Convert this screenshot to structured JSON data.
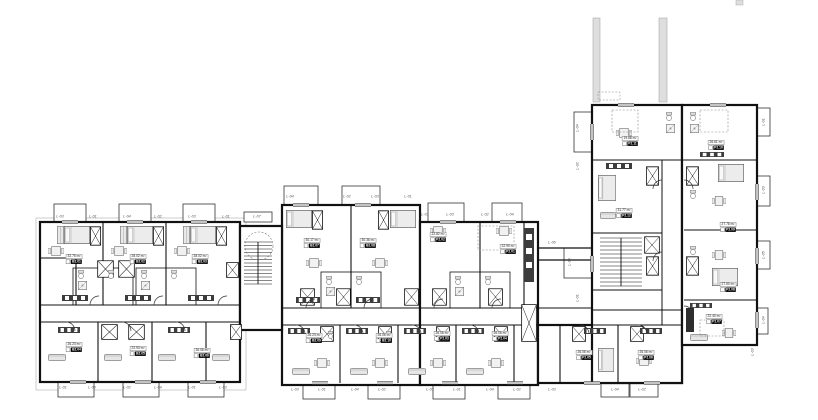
{
  "page": {
    "background": "#ffffff",
    "ink": "#111111",
    "shaft_grey": "#dedede"
  },
  "balconies": [
    "L-03",
    "L-01",
    "L-04",
    "L-02",
    "L-03",
    "L-01",
    "L-07",
    "L-01",
    "L-03",
    "L-02",
    "L-04",
    "L-01",
    "L-03",
    "L-04",
    "L-02",
    "L-03",
    "L-01",
    "L-01",
    "L-03",
    "L-02",
    "L-04",
    "L-03",
    "L-01",
    "L-04",
    "L-02",
    "L-03",
    "L-01",
    "L-04",
    "L-02",
    "L-03",
    "L-04",
    "L-02",
    "L-06",
    "L-04",
    "L-02",
    "L-03",
    "L-01",
    "L-01",
    "L-03",
    "L-05",
    "L-04",
    "L-03"
  ],
  "units": [
    {
      "code": "B2.01",
      "area": "32.75 m²"
    },
    {
      "code": "B2.02",
      "area": "28.02 m²"
    },
    {
      "code": "B2.03",
      "area": "28.02 m²"
    },
    {
      "code": "B2.04",
      "area": "26.23 m²"
    },
    {
      "code": "B2.05",
      "area": "22.93 m²"
    },
    {
      "code": "B2.06",
      "area": "26.06 m²"
    },
    {
      "code": "B2.07",
      "area": "30.17 m²"
    },
    {
      "code": "B2.08",
      "area": "30.36 m²"
    },
    {
      "code": "P2.02",
      "area": "22.82 m²"
    },
    {
      "code": "P2.01",
      "area": "22.90 m²"
    },
    {
      "code": "B2.09",
      "area": "26.23 m²"
    },
    {
      "code": "B2.10",
      "area": "26.06 m²"
    },
    {
      "code": "P2.03",
      "area": "26.06 m²"
    },
    {
      "code": "P2.04",
      "area": "26.06 m²"
    },
    {
      "code": "P2.05",
      "area": "26.06 m²"
    },
    {
      "code": "P2.06",
      "area": "26.06 m²"
    },
    {
      "code": "P2.11",
      "area": "19.88 m²"
    },
    {
      "code": "P2.10",
      "area": "26.61 m²"
    },
    {
      "code": "P2.12",
      "area": "31.77 m²"
    },
    {
      "code": "P2.09",
      "area": "27.78 m²"
    },
    {
      "code": "P2.08",
      "area": "27.50 m²"
    },
    {
      "code": "P2.07",
      "area": "22.40 m²"
    }
  ]
}
